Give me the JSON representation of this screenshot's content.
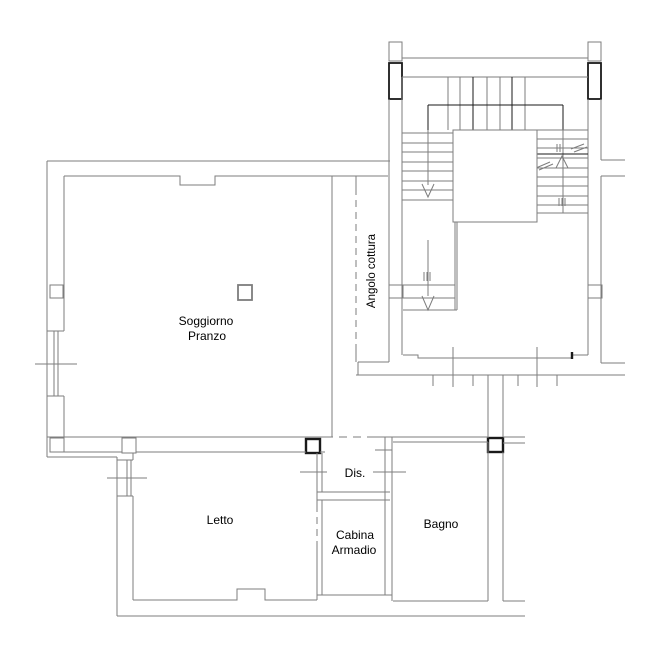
{
  "plan": {
    "rooms": {
      "soggiorno": {
        "label_line1": "Soggiorno",
        "label_line2": "Pranzo"
      },
      "angolo_cottura": {
        "label": "Angolo cottura"
      },
      "letto": {
        "label": "Letto"
      },
      "disimpegno": {
        "label": "Dis."
      },
      "cabina_armadio": {
        "label_line1": "Cabina",
        "label_line2": "Armadio"
      },
      "bagno": {
        "label": "Bagno"
      }
    },
    "colors": {
      "wall_gray": "#7d7d7d",
      "line_black": "#1a1a1a",
      "background": "#ffffff"
    }
  }
}
